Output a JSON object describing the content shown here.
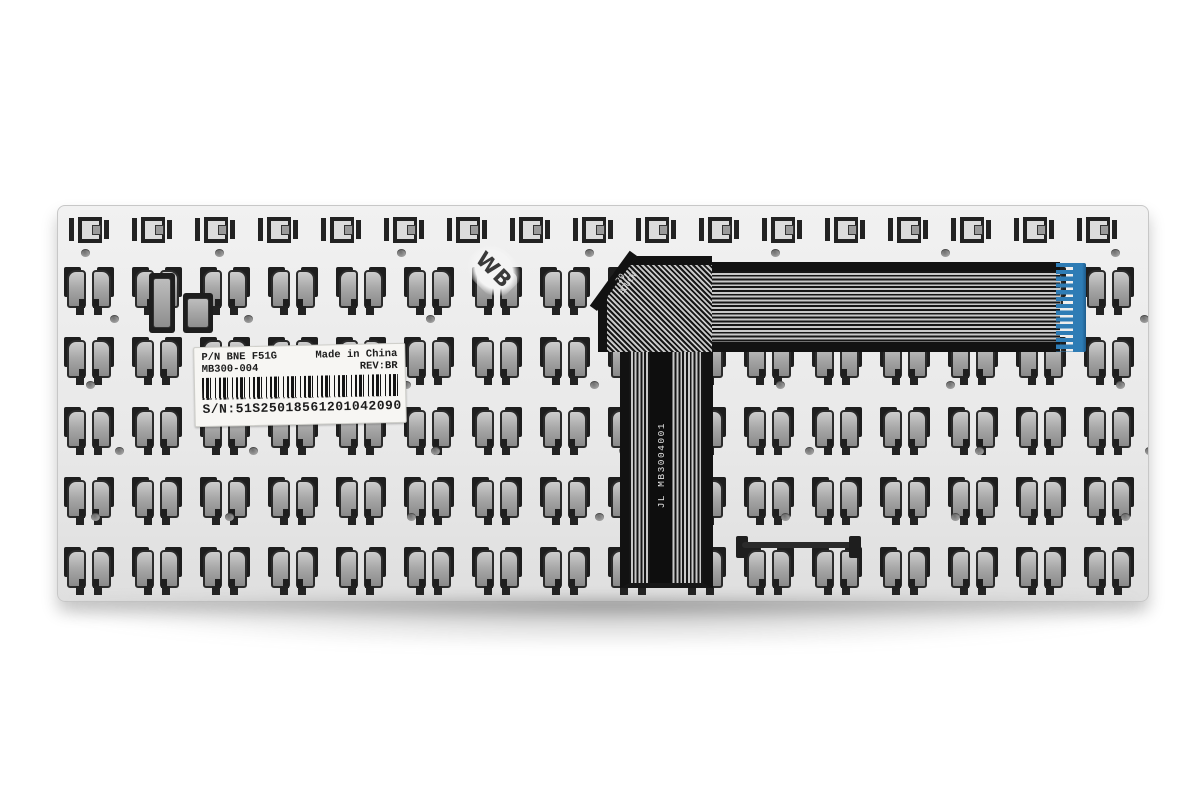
{
  "product_photo": {
    "subject": "laptop keyboard replacement backplate, rear view",
    "handwritten_mark": "WB"
  },
  "label": {
    "pn_line_left": "P/N BNE F51G",
    "pn_line_right": "Made in China",
    "model_line_left": "MB300-004",
    "model_line_right": "REV:BR",
    "serial_line": "S/N:51S25018561201042090"
  },
  "ribbon": {
    "side_text": "JL  MB3004001",
    "fold_text_line1": "20",
    "fold_text_line2": "BOUCW",
    "connector_color": "#2e7cb5"
  },
  "colors": {
    "background": "#ffffff",
    "plate": "#ebebeb",
    "plate_edge": "#c7c7c7",
    "cutout_dark": "#1e1e1e",
    "clip_light": "#c9c9c9",
    "clip_dark": "#8a8a8a",
    "ribbon_dark": "#161616",
    "ribbon_stripe": "#c9c9c9",
    "connector_blue": "#2e7cb5"
  },
  "grid": {
    "function_row": {
      "y": 11,
      "start_x": 11,
      "step": 63,
      "count": 17
    },
    "main_rows": {
      "ys": [
        61,
        131,
        201,
        271,
        341
      ],
      "start_x": 5,
      "step": 68,
      "count": 16
    },
    "holes": {
      "ys": [
        43,
        109,
        175,
        241,
        307
      ],
      "xs": [
        23,
        157,
        339,
        527,
        713,
        883,
        1053
      ]
    }
  }
}
